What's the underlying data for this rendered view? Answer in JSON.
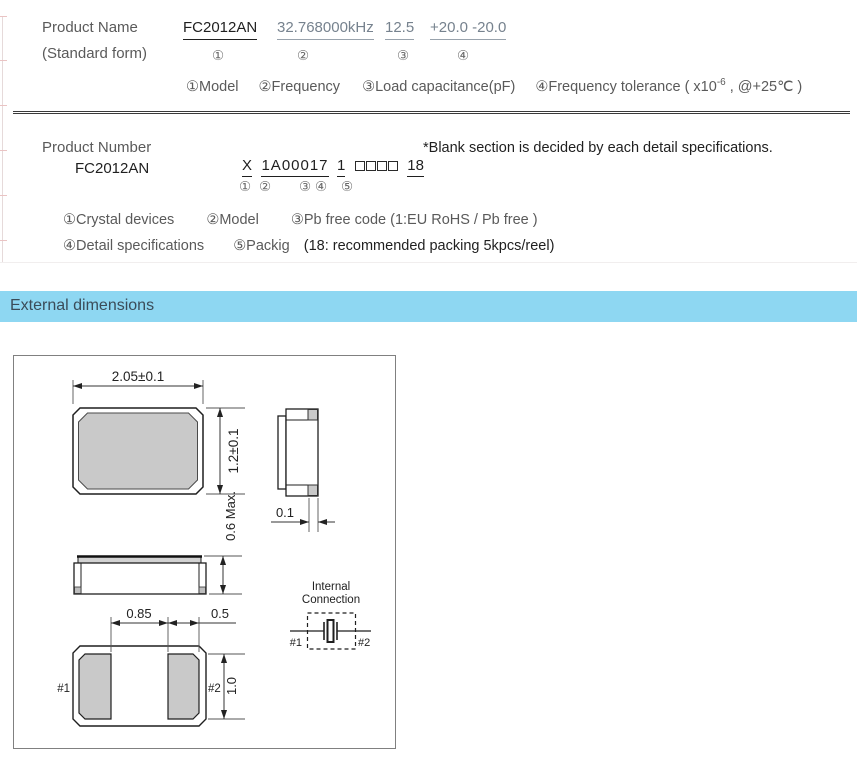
{
  "product_name": {
    "label": "Product Name",
    "sublabel": "(Standard form)",
    "model": "FC2012AN",
    "frequency": "32.768000kHz",
    "load_capacitance": "12.5",
    "tolerance": "+20.0 -20.0",
    "circled": {
      "c1": "①",
      "c2": "②",
      "c3": "③",
      "c4": "④"
    },
    "legend": {
      "model": "①Model",
      "frequency": "②Frequency",
      "load": "③Load capacitance(pF)",
      "tol_pre": "④Frequency tolerance ( x10",
      "tol_sup": "-6",
      "tol_post": " , @+25℃ )"
    }
  },
  "product_number": {
    "label": "Product Number",
    "note": "*Blank section is decided by each detail specifications.",
    "model": "FC2012AN",
    "code": {
      "p1": "X",
      "p2": "1A00017",
      "p3": "1",
      "p5": "18"
    },
    "circled": {
      "c1": "①",
      "c2": "②",
      "c3": "③",
      "c4": "④",
      "c5": "⑤"
    },
    "legend1": {
      "a": "①Crystal devices",
      "b": "②Model",
      "c": "③Pb free code (1:EU RoHS / Pb free )"
    },
    "legend2": {
      "a": "④Detail specifications",
      "b": "⑤Packig",
      "c": "(18: recommended packing 5kpcs/reel)"
    }
  },
  "section_header": {
    "title": "External dimensions"
  },
  "dims": {
    "top_width": "2.05±0.1",
    "top_height": "1.2±0.1",
    "lid_offset": "0.1",
    "height_max": "0.6 Max.",
    "pad_gap": "0.85",
    "pad_width": "0.5",
    "pad_height": "1.0",
    "pin1": "#1",
    "pin2": "#2",
    "internal_line1": "Internal",
    "internal_line2": "Connection",
    "ic_pin1": "#1",
    "ic_pin2": "#2"
  },
  "colors": {
    "section_bar_bg": "#8ed7f2",
    "section_bar_text": "#3b4c59",
    "pad_fill": "#c9c9c9",
    "value_text": "#76828e"
  }
}
